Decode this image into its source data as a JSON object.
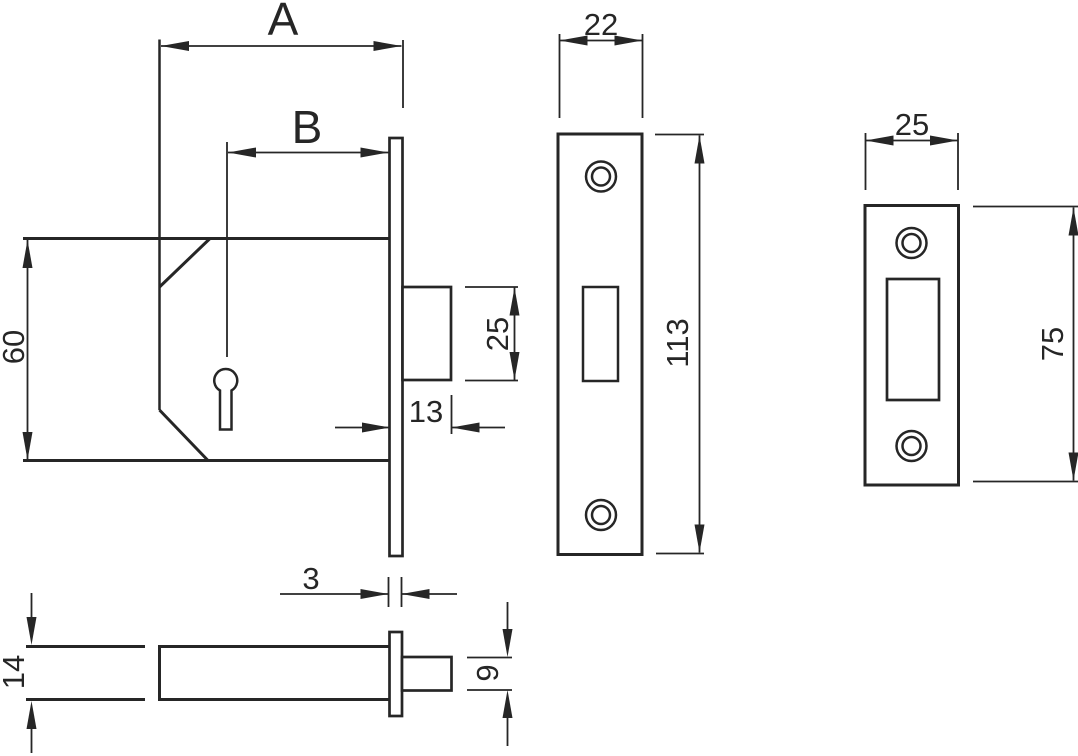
{
  "drawing": {
    "background_color": "#ffffff",
    "line_color": "#262626",
    "views": {
      "side": {
        "labels": {
          "case_depth": "A",
          "backset": "B",
          "case_height": "60",
          "bolt_height": "25",
          "bolt_throw": "13",
          "faceplate_thickness": "3"
        }
      },
      "faceplate": {
        "labels": {
          "width": "22",
          "height": "113"
        }
      },
      "strike": {
        "labels": {
          "width": "25",
          "height": "75"
        }
      },
      "plan": {
        "labels": {
          "case_thickness": "14",
          "bolt_width": "9"
        }
      }
    }
  }
}
